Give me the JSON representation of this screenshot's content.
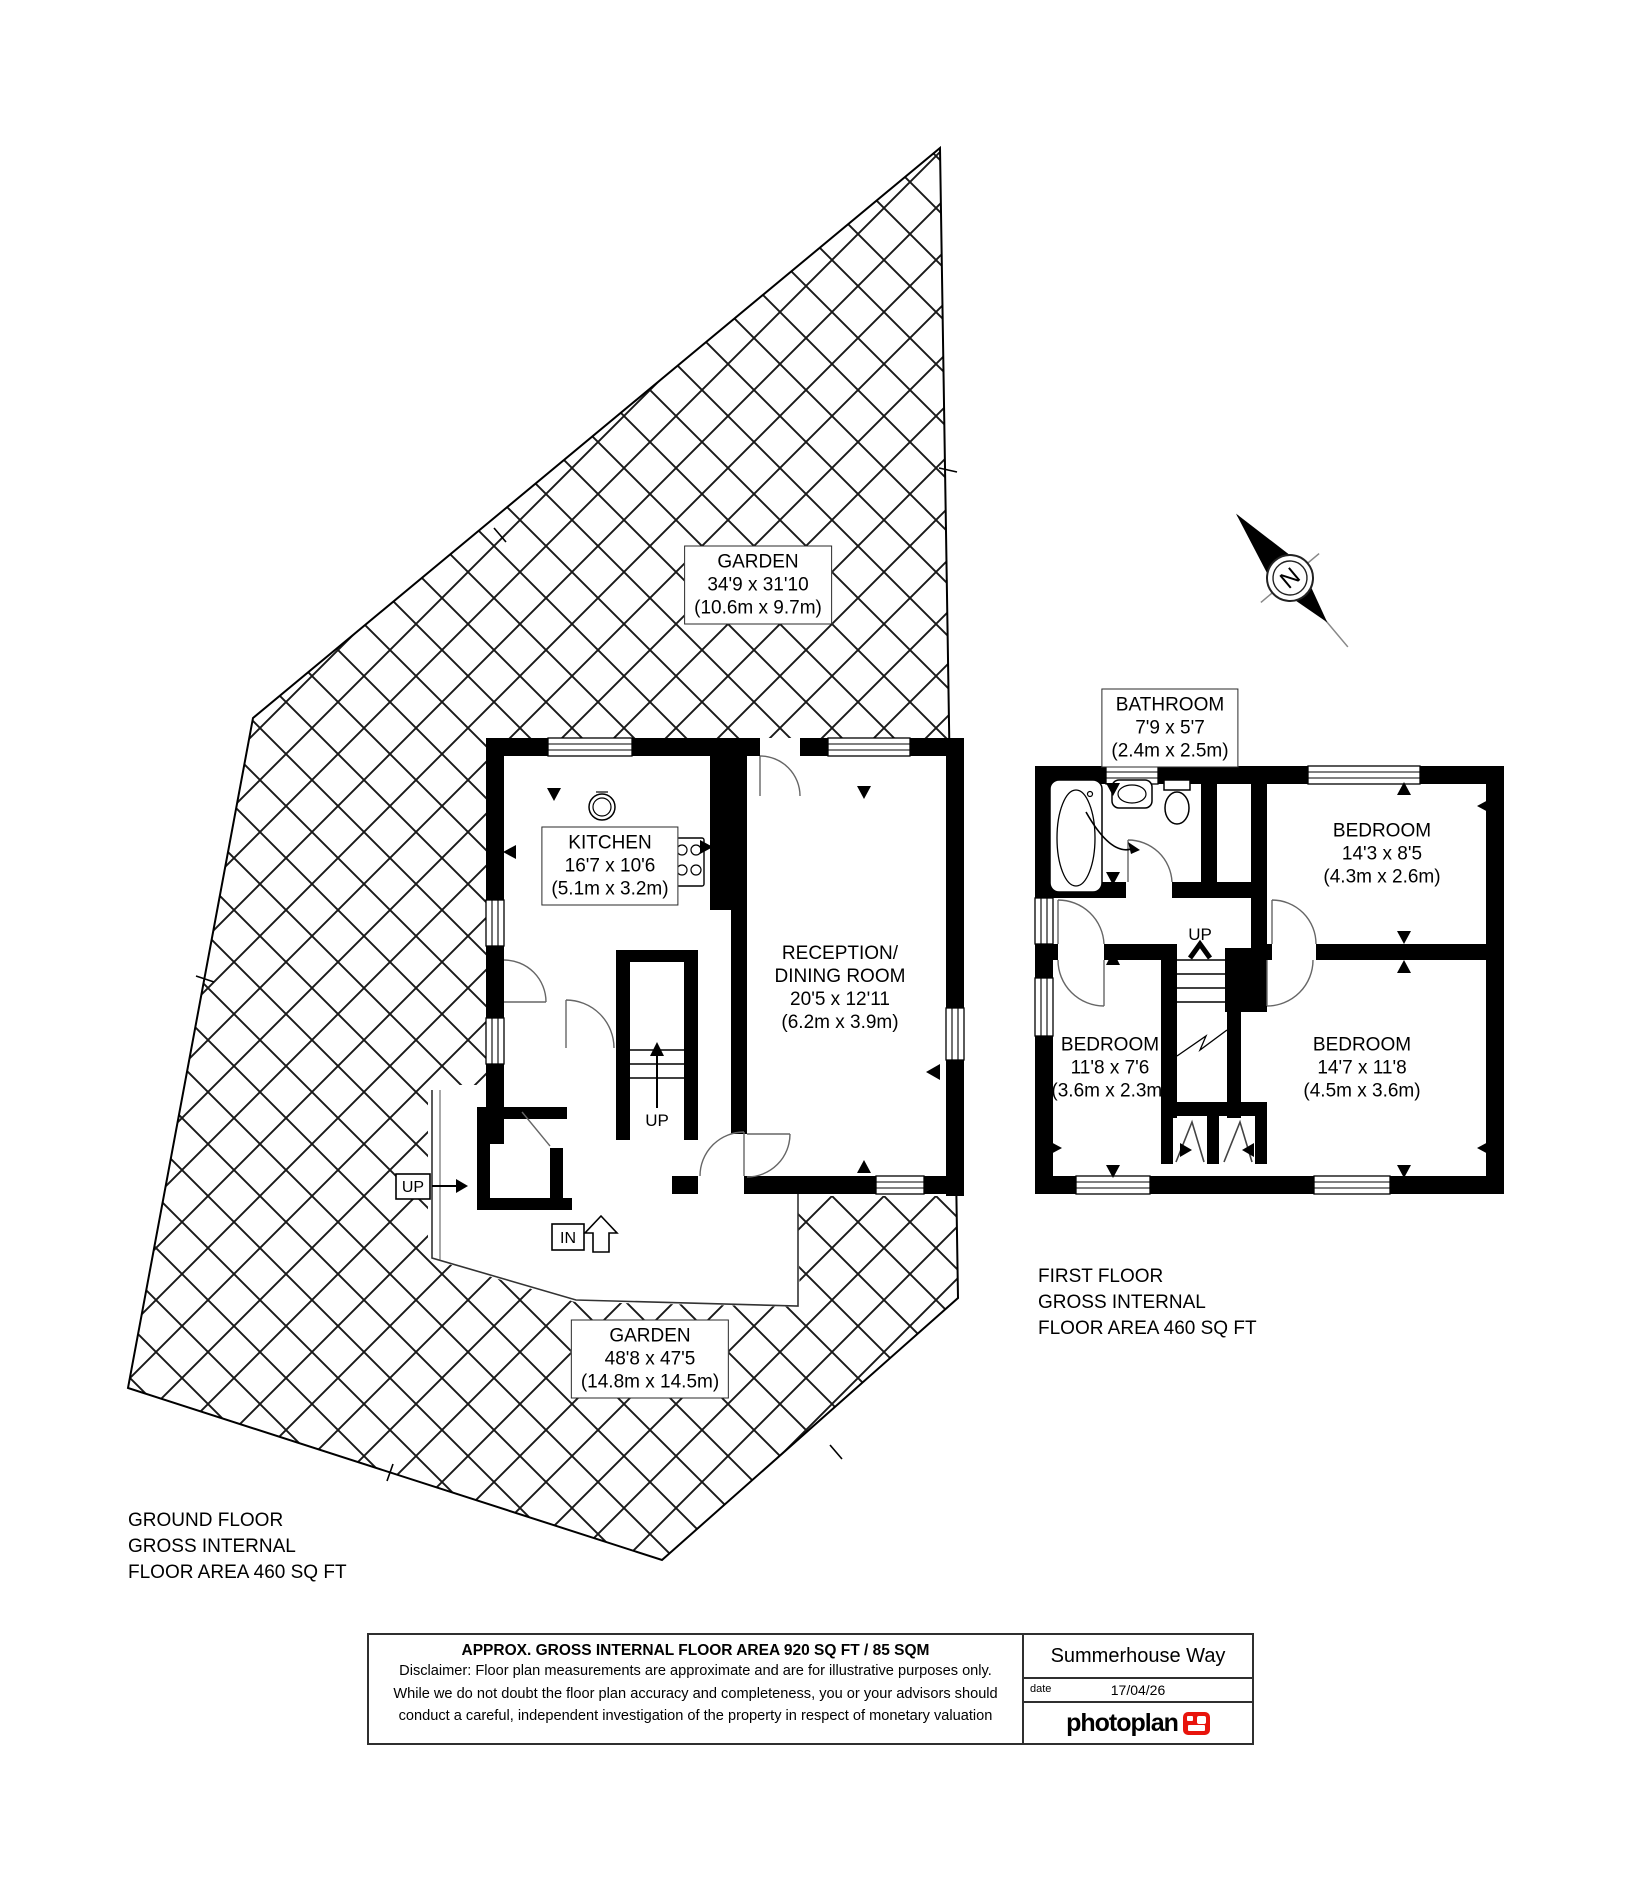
{
  "title": "Summerhouse Way Floor Plan",
  "rooms": {
    "garden_top": {
      "name": "GARDEN",
      "imperial": "34'9 x 31'10",
      "metric": "(10.6m x 9.7m)"
    },
    "kitchen": {
      "name": "KITCHEN",
      "imperial": "16'7 x 10'6",
      "metric": "(5.1m x 3.2m)"
    },
    "reception": {
      "name_line1": "RECEPTION/",
      "name_line2": "DINING ROOM",
      "imperial": "20'5 x 12'11",
      "metric": "(6.2m x 3.9m)"
    },
    "bathroom": {
      "name": "BATHROOM",
      "imperial": "7'9 x 5'7",
      "metric": "(2.4m x 2.5m)"
    },
    "bedroom_top_right": {
      "name": "BEDROOM",
      "imperial": "14'3 x 8'5",
      "metric": "(4.3m x 2.6m)"
    },
    "bedroom_bottom_left": {
      "name": "BEDROOM",
      "imperial": "11'8 x 7'6",
      "metric": "(3.6m x 2.3m)"
    },
    "bedroom_bottom_right": {
      "name": "BEDROOM",
      "imperial": "14'7 x 11'8",
      "metric": "(4.5m x 3.6m)"
    },
    "garden_bottom": {
      "name": "GARDEN",
      "imperial": "48'8 x 47'5",
      "metric": "(14.8m x 14.5m)"
    }
  },
  "floor_summaries": {
    "ground": {
      "line1": "GROUND FLOOR",
      "line2": "GROSS INTERNAL",
      "line3": "FLOOR AREA 460 SQ FT"
    },
    "first": {
      "line1": "FIRST FLOOR",
      "line2": "GROSS INTERNAL",
      "line3": "FLOOR AREA 460 SQ FT"
    }
  },
  "markers": {
    "up": "UP",
    "in": "IN",
    "north": "N"
  },
  "footer": {
    "area_title": "APPROX. GROSS INTERNAL FLOOR AREA 920 SQ FT / 85 SQM",
    "disclaimer_line1": "Disclaimer: Floor plan measurements are approximate and are for illustrative purposes only.",
    "disclaimer_line2": "While we do not doubt the floor plan accuracy and completeness, you or your advisors should",
    "disclaimer_line3": "conduct a careful, independent investigation of the property in respect of monetary valuation",
    "address": "Summerhouse Way",
    "date_label": "date",
    "date_value": "17/04/26",
    "brand": "photoplan"
  },
  "colors": {
    "wall": "#000000",
    "brand_red": "#e8140c",
    "hatch_line": "#1a1a1a"
  }
}
